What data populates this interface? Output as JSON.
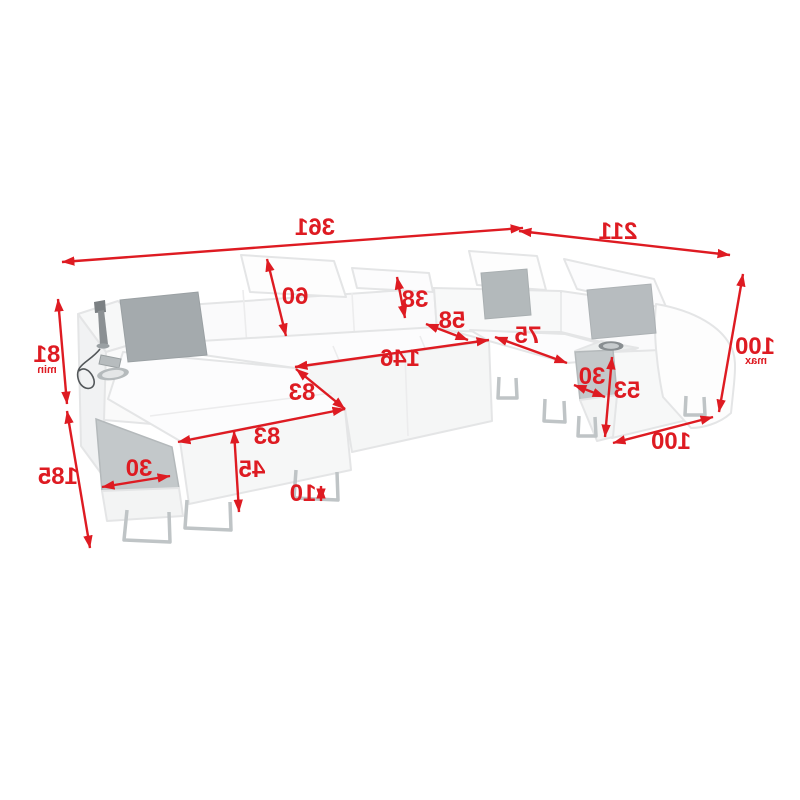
{
  "diagram": {
    "description": "corner-sofa-dimension-diagram-mirrored",
    "palette": {
      "dimension_red": "#de1b22",
      "sofa_fill": "#fbfbfc",
      "sofa_outline": "#e4e5e6",
      "console_gray": "#c3c8ca",
      "pillow_gray": "#aab0b3",
      "leg_chrome": "#bfc4c6"
    },
    "dims": {
      "d361": {
        "label": "361"
      },
      "d211": {
        "label": "211"
      },
      "d100max": {
        "label": "100",
        "suffix": "max"
      },
      "d81min": {
        "label": "81",
        "suffix": "min"
      },
      "d185": {
        "label": "185"
      },
      "d60": {
        "label": "60"
      },
      "d38": {
        "label": "38"
      },
      "d58": {
        "label": "58"
      },
      "d146": {
        "label": "146"
      },
      "d75": {
        "label": "75"
      },
      "d30right": {
        "label": "30"
      },
      "d53": {
        "label": "53"
      },
      "d100bottom": {
        "label": "100"
      },
      "d83corner": {
        "label": "83"
      },
      "d83front": {
        "label": "83"
      },
      "d45": {
        "label": "45"
      },
      "d30left": {
        "label": "30"
      },
      "d10": {
        "label": "10"
      }
    }
  }
}
